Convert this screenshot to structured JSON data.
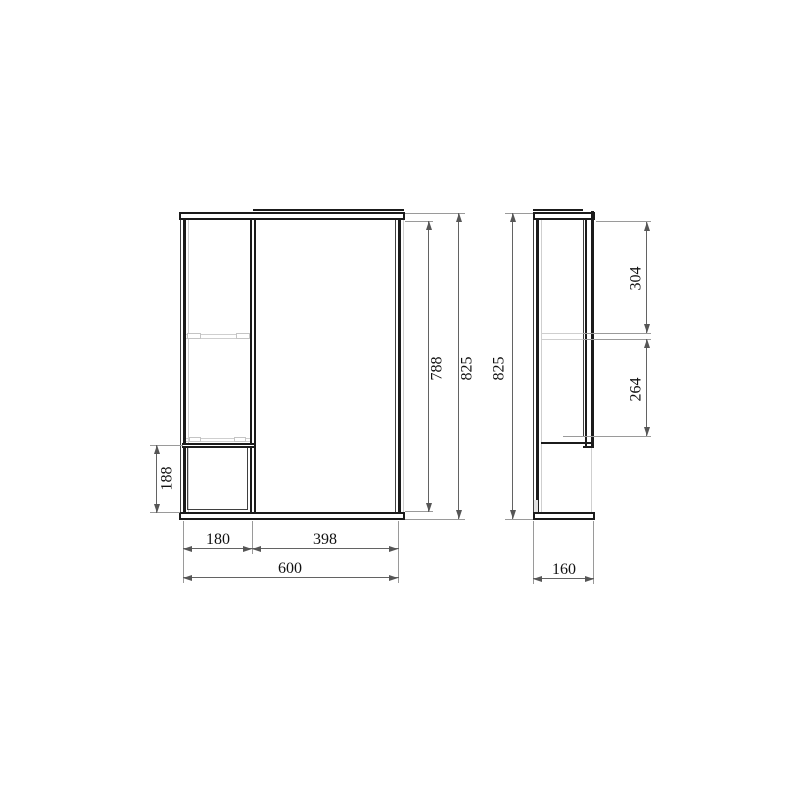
{
  "front_view": {
    "total_width": "600",
    "left_section_width": "180",
    "right_section_width": "398",
    "lower_left_height": "188",
    "inner_height": "788",
    "overall_height": "825"
  },
  "side_view": {
    "depth": "160",
    "overall_height": "825",
    "upper_compartment_height": "304",
    "lower_compartment_height": "264"
  },
  "colors": {
    "background": "#ffffff",
    "object_line": "#1b1b1b",
    "dimension_line": "#636363",
    "extension_line": "#9a9a9a",
    "detail_line": "#cfcfcf",
    "text": "#111111"
  }
}
